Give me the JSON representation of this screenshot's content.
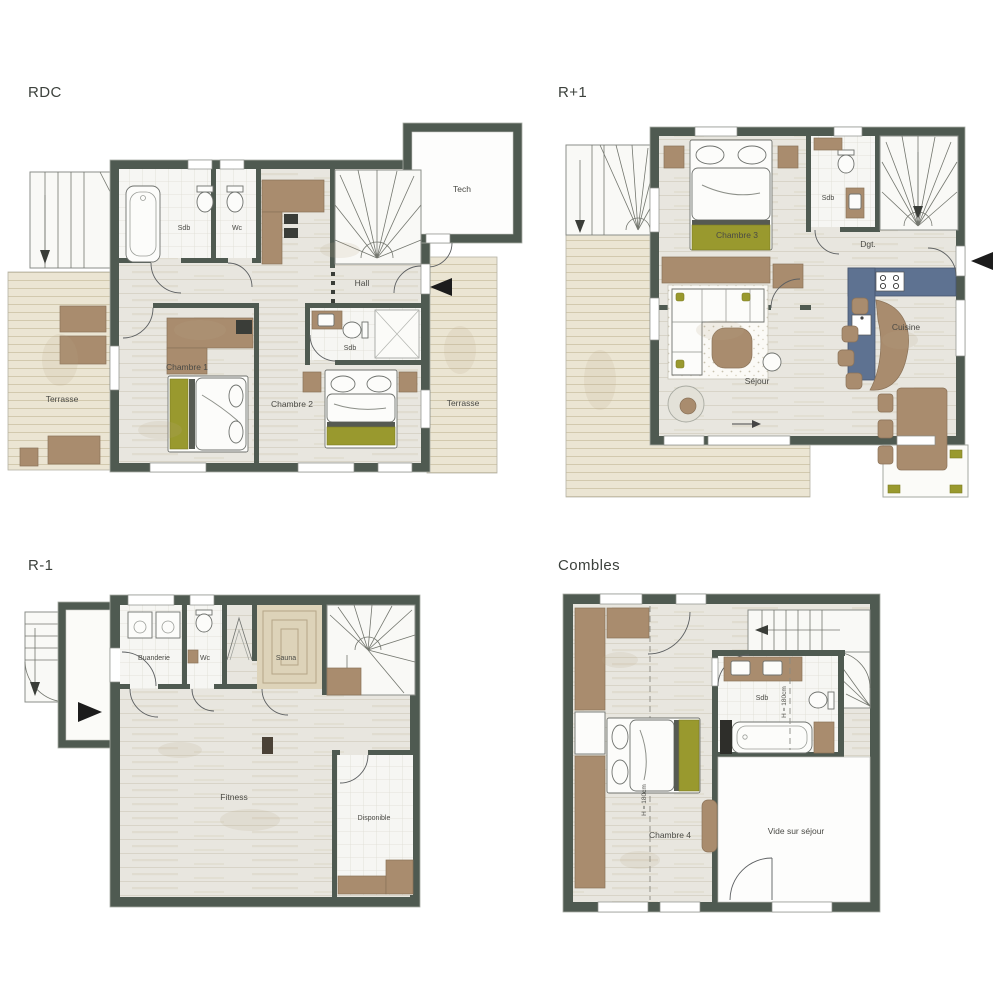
{
  "document": {
    "type": "chalet-floor-plans",
    "plan_count": 4
  },
  "colors": {
    "background": "#ffffff",
    "wall": "#4f5a51",
    "floor_wood": "#e8e6df",
    "terrace_deck": "#ebe5d3",
    "tile": "#f6f6f3",
    "furniture_brown": "#a98c6e",
    "accent_olive": "#99992e",
    "kitchen_counter": "#5e7291",
    "sauna": "#ddd3b9",
    "entry_arrow": "#1c1c1c"
  },
  "floors": {
    "rdc": {
      "title": "RDC",
      "rooms": {
        "sdb": "Sdb",
        "wc": "Wc",
        "hall": "Hall",
        "chambre1": "Chambre 1",
        "chambre2": "Chambre 2",
        "sdb2": "Sdb",
        "tech": "Tech",
        "terrasse_left": "Terrasse",
        "terrasse_right": "Terrasse"
      }
    },
    "r_plus_1": {
      "title": "R+1",
      "rooms": {
        "chambre3": "Chambre 3",
        "sdb": "Sdb",
        "dgt": "Dgt.",
        "cuisine": "Cuisine",
        "sejour": "Séjour"
      }
    },
    "r_minus_1": {
      "title": "R-1",
      "rooms": {
        "buanderie": "Buanderie",
        "wc": "Wc",
        "sauna": "Sauna",
        "fitness": "Fitness",
        "disponible": "Disponible"
      }
    },
    "combles": {
      "title": "Combles",
      "rooms": {
        "chambre4": "Chambre 4",
        "sdb": "Sdb",
        "vide_sur_sejour": "Vide sur séjour"
      },
      "annotations": {
        "height_line_1": "H = 180cm",
        "height_line_2": "H = 180cm"
      }
    }
  }
}
